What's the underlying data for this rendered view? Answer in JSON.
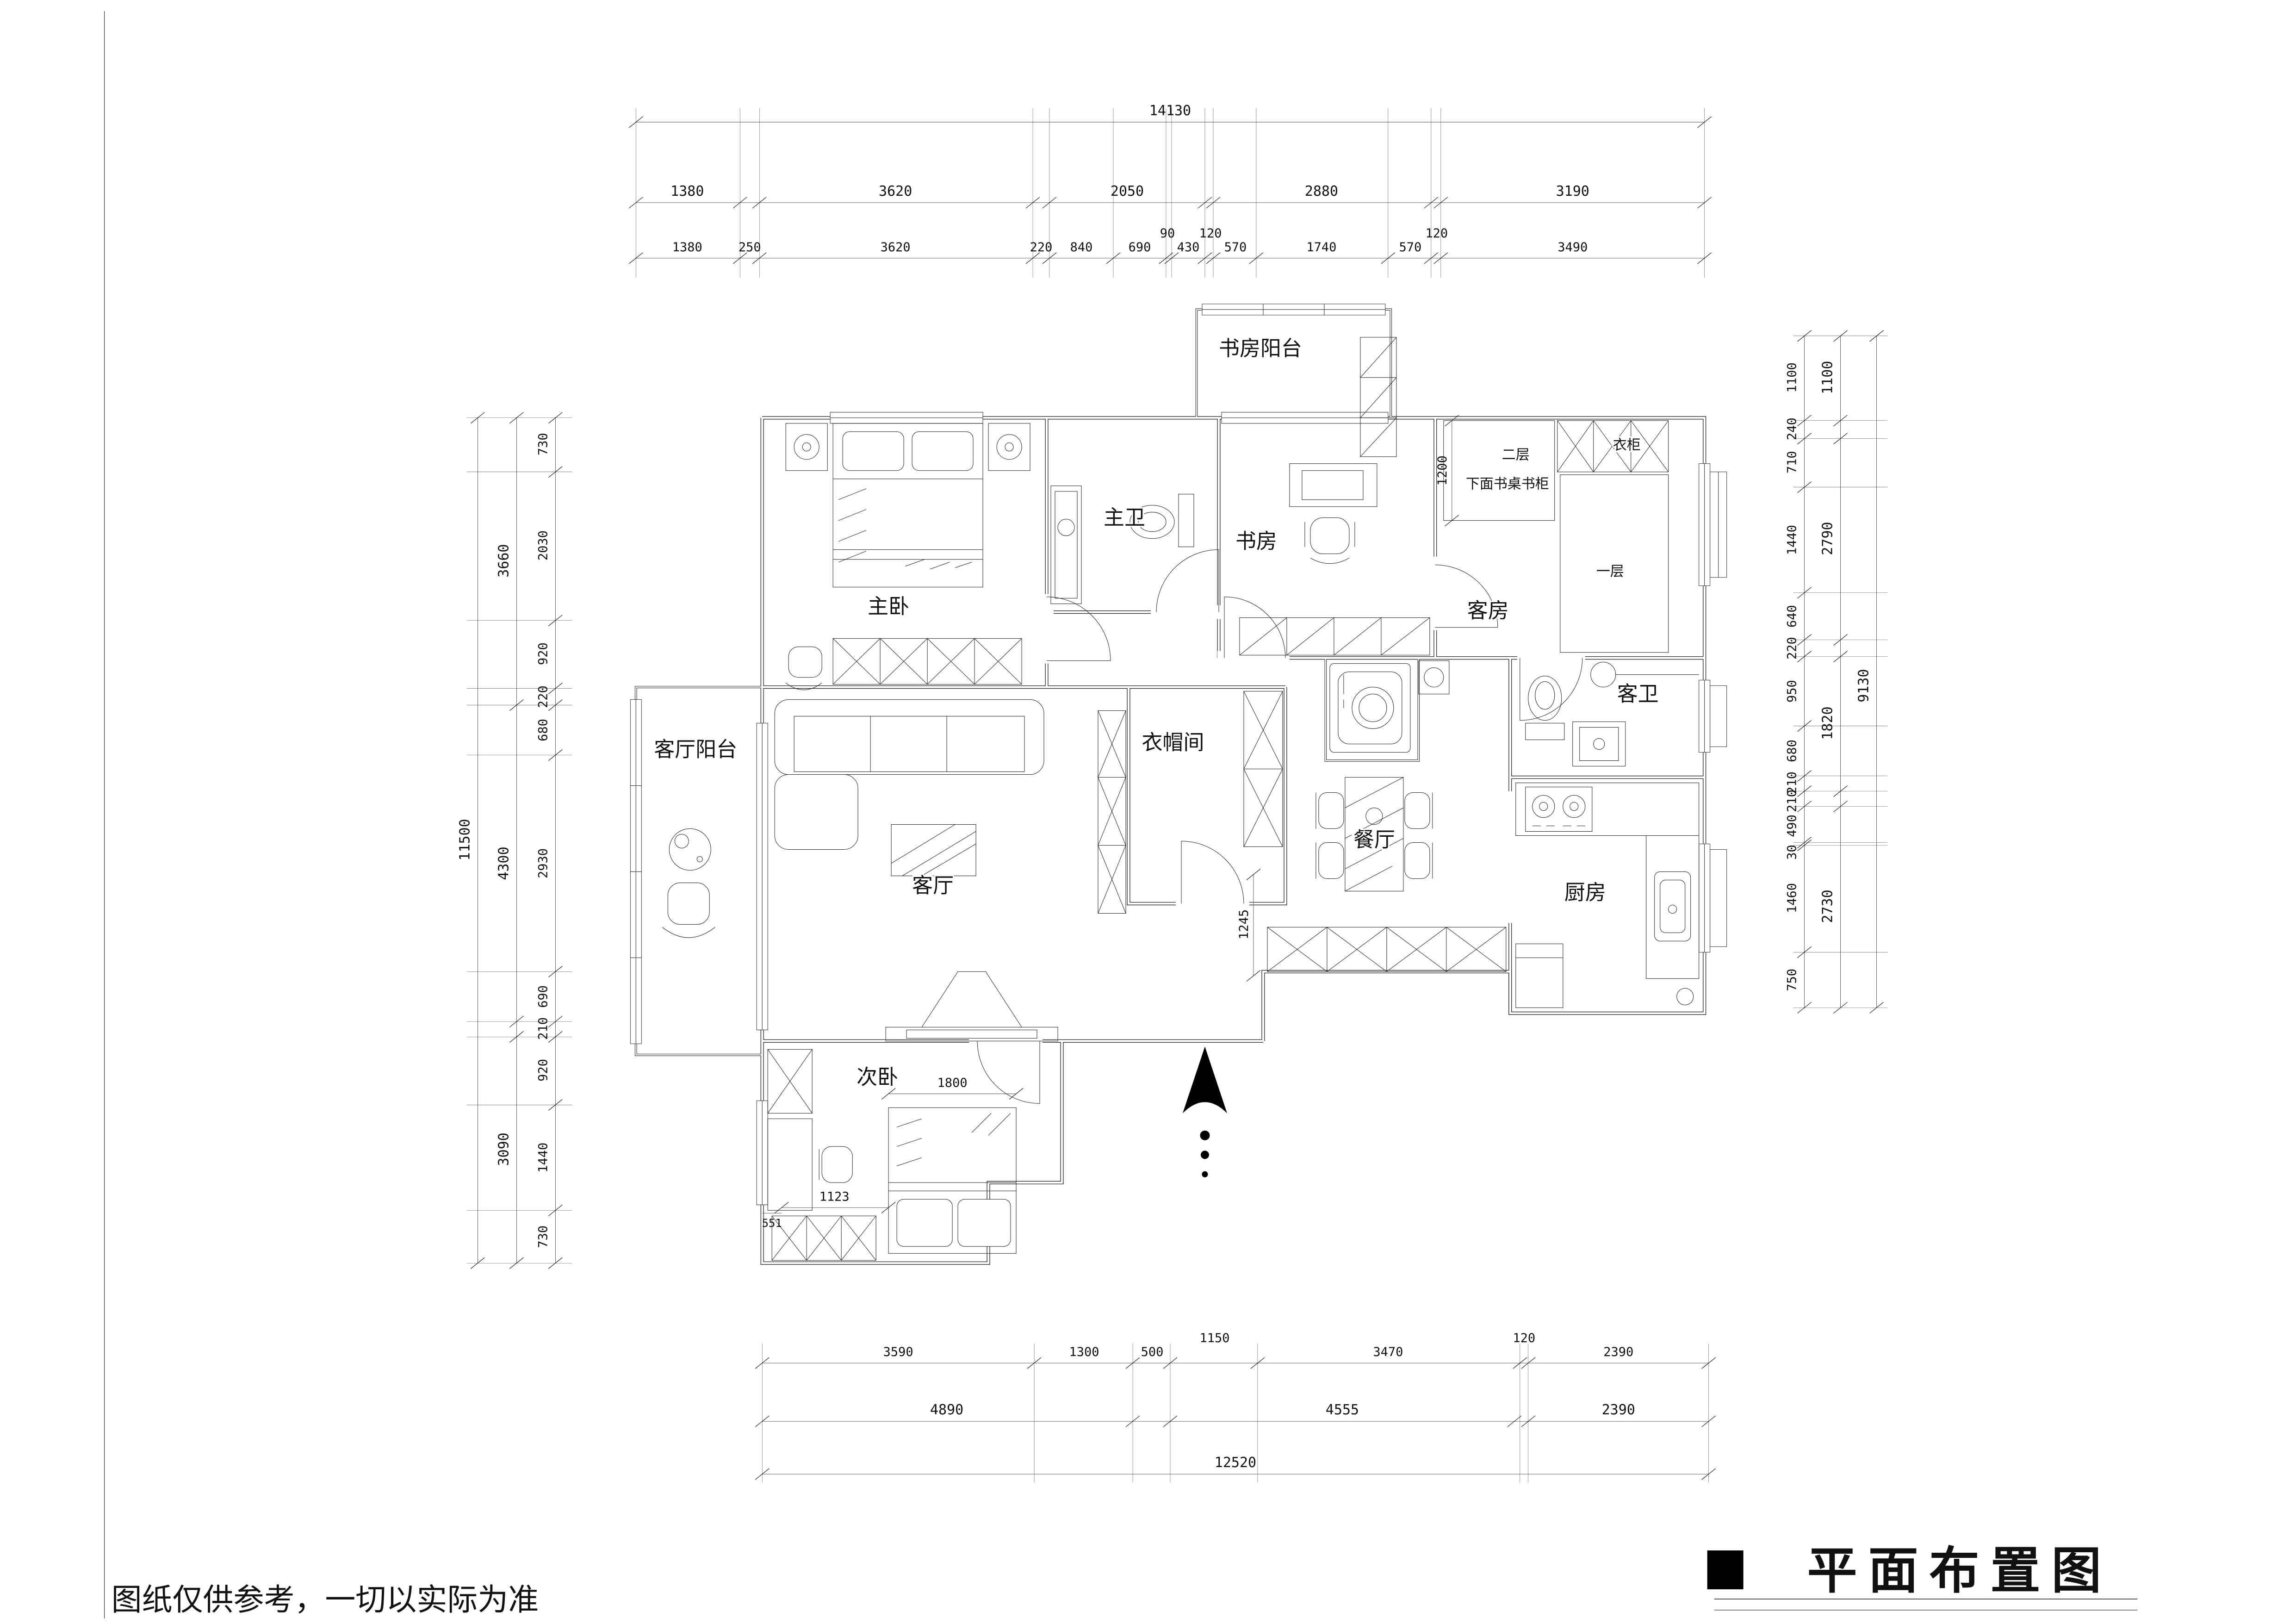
{
  "sheet": {
    "note": "图纸仅供参考，一切以实际为准",
    "title": "平面布置图"
  },
  "rooms": {
    "study_balcony": "书房阳台",
    "master_bedroom": "主卧",
    "master_bath": "主卫",
    "study": "书房",
    "guest_room": "客房",
    "guest_bath": "客卫",
    "cloakroom": "衣帽间",
    "living_balcony": "客厅阳台",
    "living_room": "客厅",
    "dining_room": "餐厅",
    "kitchen": "厨房",
    "second_bedroom": "次卧"
  },
  "annotations": {
    "wardrobe": "衣柜",
    "bunk_upper": "二层",
    "bunk_under": "下面书桌书柜",
    "bed_lower": "一层"
  },
  "dims": {
    "top_total": "14130",
    "top_groups": [
      "1380",
      "3620",
      "2050",
      "2880",
      "3190"
    ],
    "top_detail": [
      "1380",
      "250",
      "3620",
      "220",
      "840",
      "690",
      "90",
      "430",
      "120",
      "570",
      "1740",
      "570",
      "120",
      "3490"
    ],
    "left_total": "11500",
    "left_groups": [
      "3660",
      "4300",
      "3090"
    ],
    "left_detail": [
      "730",
      "2030",
      "920",
      "220",
      "680",
      "2930",
      "690",
      "210",
      "920",
      "1440",
      "730"
    ],
    "right_total": "9130",
    "right_groups": [
      "1100",
      "2790",
      "1820",
      "2730"
    ],
    "right_detail": [
      "1100",
      "240",
      "710",
      "1440",
      "640",
      "220",
      "950",
      "680",
      "210",
      "210",
      "490",
      "30",
      "1460",
      "750"
    ],
    "bottom_total": "12520",
    "bottom_groups": [
      "4890",
      "4555",
      "2390"
    ],
    "bottom_detail": [
      "3590",
      "1300",
      "500",
      "1150",
      "3470",
      "120",
      "2390"
    ],
    "interior": {
      "guest_bunk_width": "1200",
      "second_bed_width": "1800",
      "second_desk": "1123",
      "second_cab": "551",
      "dining_wall": "1245"
    }
  }
}
